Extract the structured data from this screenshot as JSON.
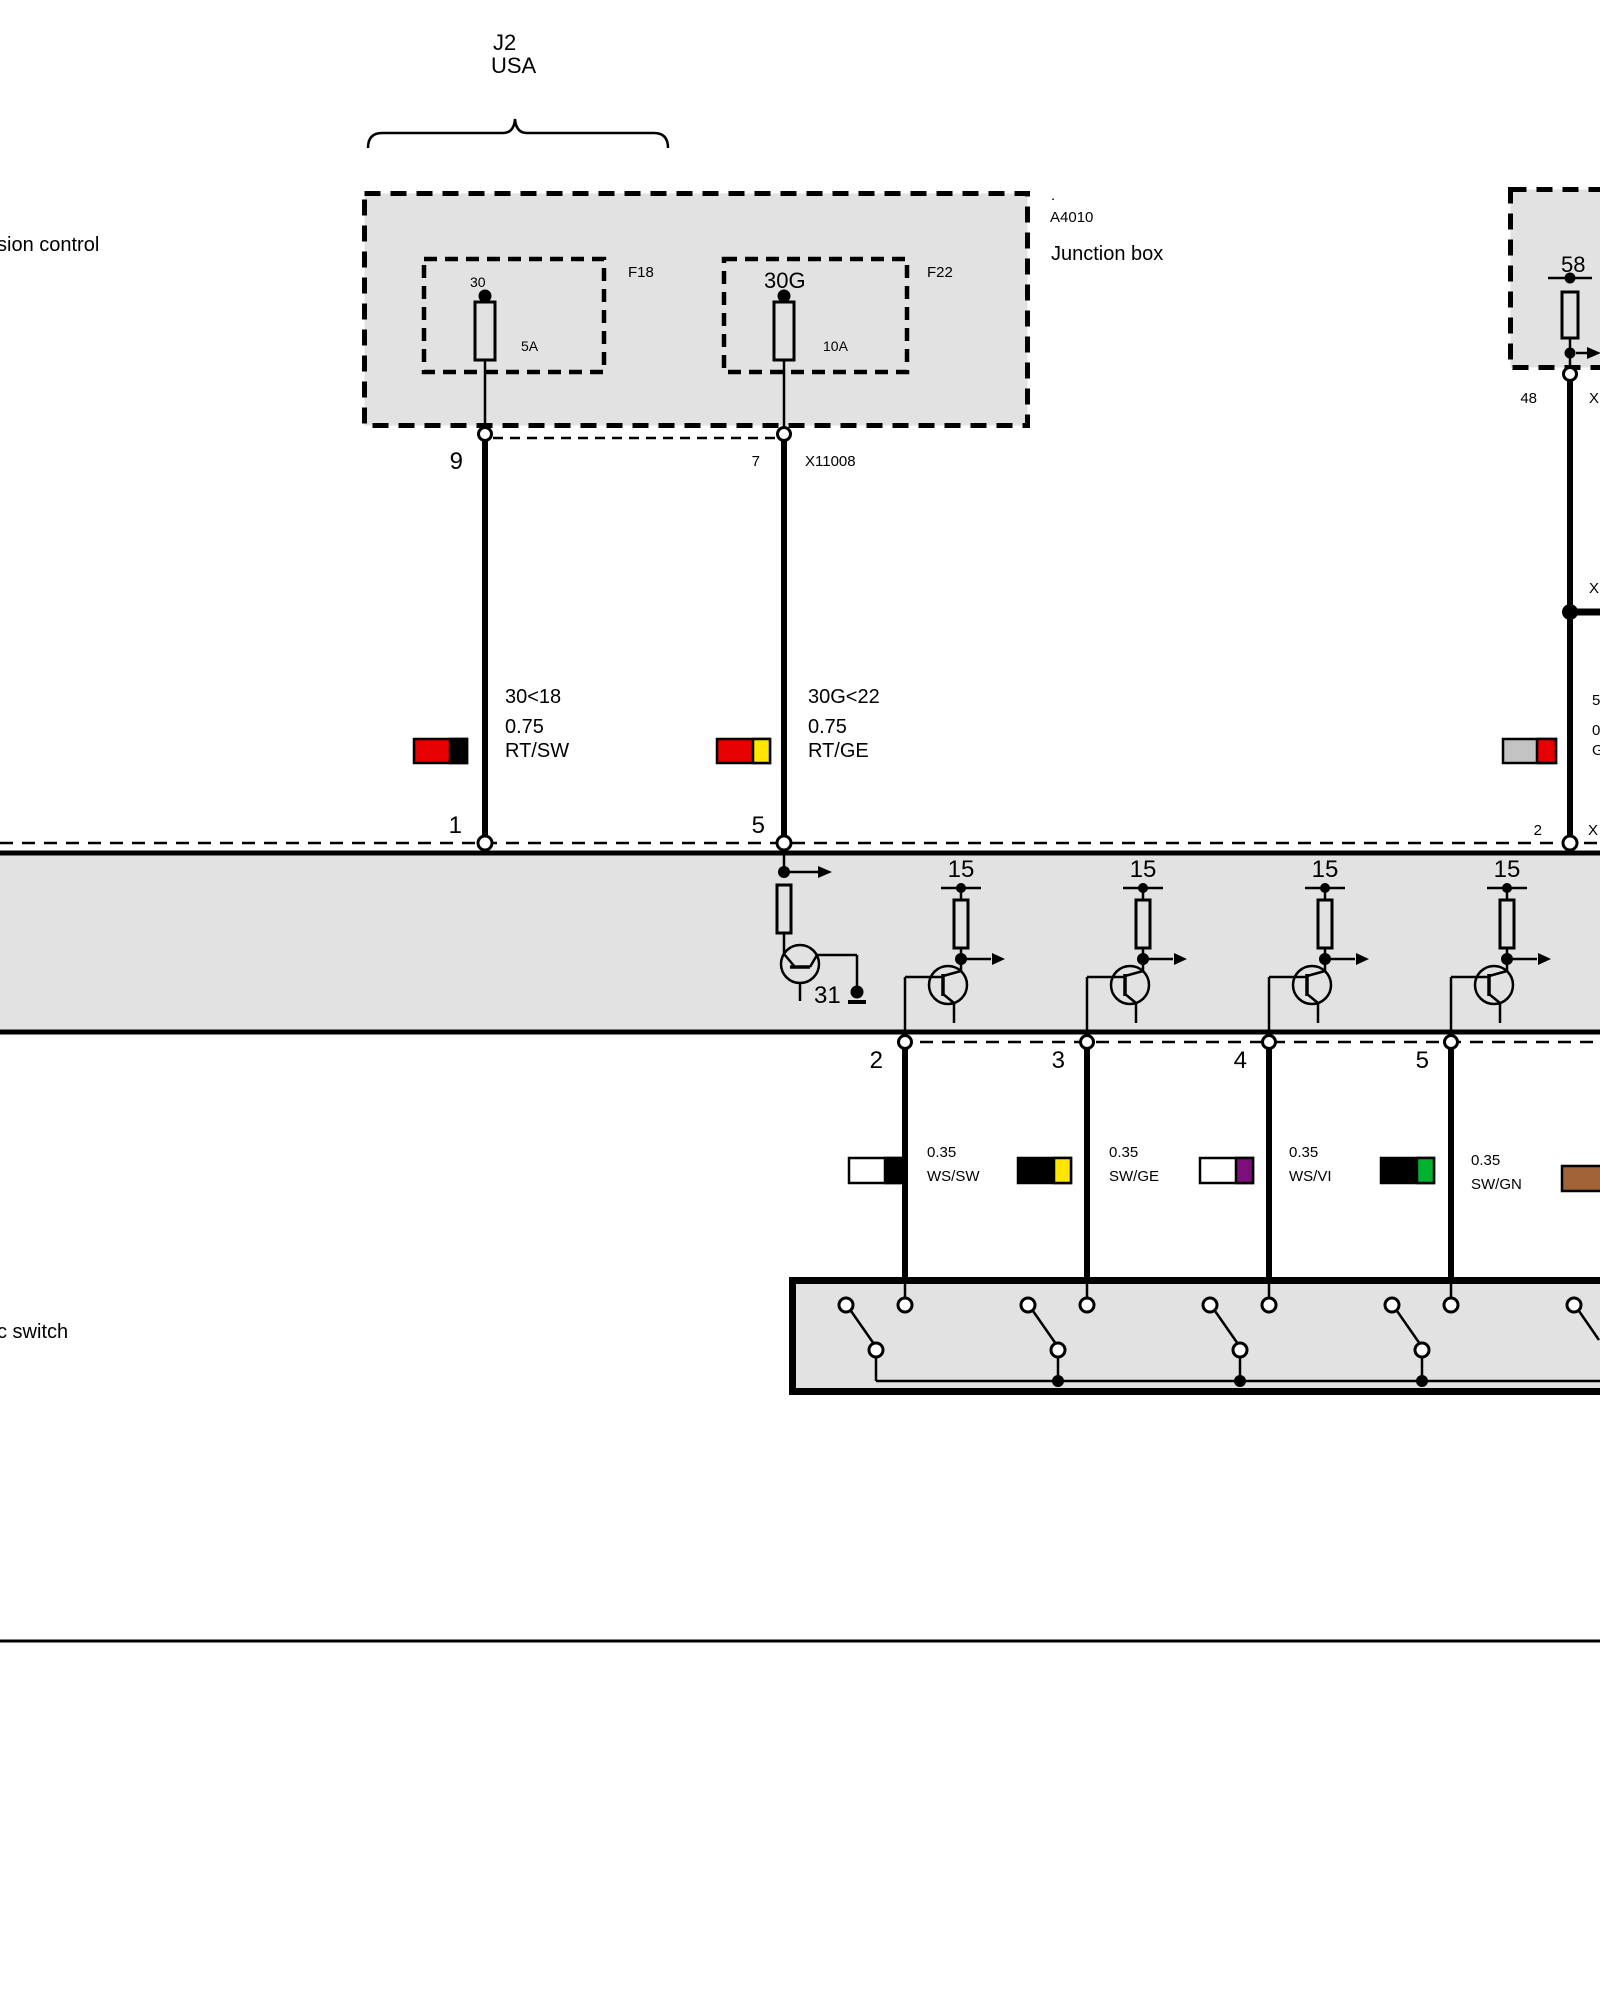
{
  "labels": {
    "top_line1": "J2",
    "top_line2": "USA",
    "left_top": "sion control",
    "left_bottom": "c switch"
  },
  "junction_box": {
    "dot": ".",
    "code": "A4010",
    "name": "Junction box",
    "fuse1": {
      "terminal": "30",
      "slot": "F18",
      "rating": "5A",
      "pin": "9"
    },
    "fuse2": {
      "terminal": "30G",
      "slot": "F22",
      "rating": "10A",
      "pin": "7",
      "connector": "X11008"
    }
  },
  "right_box": {
    "terminal": "58",
    "pin": "48",
    "connector": "X",
    "junction_label": "X",
    "wire_l1": "58",
    "wire_l2": "0.",
    "wire_l3": "G",
    "pin_bottom": "2",
    "connector_bottom": "X"
  },
  "wire1": {
    "l1": "30<18",
    "l2": "0.75",
    "l3": "RT/SW",
    "pin_bottom": "1"
  },
  "wire2": {
    "l1": "30G<22",
    "l2": "0.75",
    "l3": "RT/GE",
    "pin_bottom": "5"
  },
  "module": {
    "ground": "31",
    "kl15": [
      "15",
      "15",
      "15",
      "15"
    ],
    "out_pins": [
      "2",
      "3",
      "4",
      "5"
    ]
  },
  "out_wires": [
    {
      "size": "0.35",
      "code": "WS/SW"
    },
    {
      "size": "0.35",
      "code": "SW/GE"
    },
    {
      "size": "0.35",
      "code": "WS/VI"
    },
    {
      "size": "0.35",
      "code": "SW/GN"
    }
  ],
  "colors": {
    "red": "#e60000",
    "black": "#000000",
    "yellow": "#ffe600",
    "white": "#ffffff",
    "violet": "#7d0f7d",
    "green": "#00b22d",
    "brown": "#a26436",
    "gray_chip": "#c3c3c3",
    "box_fill": "#e2e2e2"
  }
}
